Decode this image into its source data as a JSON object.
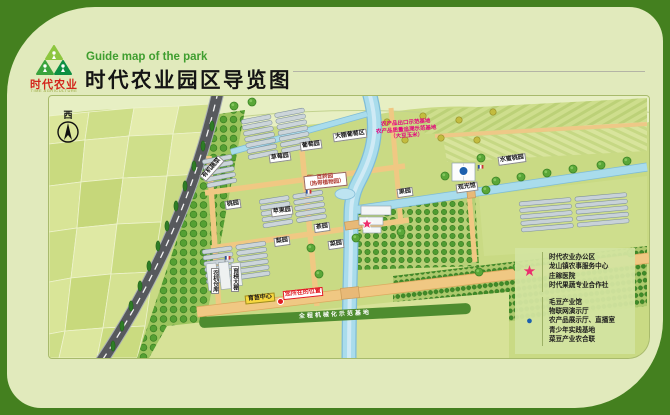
{
  "colors": {
    "page_background": "#44801f",
    "card_background": "#e1eabc",
    "brand_red": "#d3251c",
    "subtitle_green": "#3f9e2f",
    "star_marker": "#ea2f6e",
    "info_marker": "#1c60ae",
    "you_are_here_red": "#e11b22",
    "river_blue": "#a9dcec",
    "farm_road_tan": "#f0c883"
  },
  "header": {
    "logo_brand": "时代农业",
    "logo_caption": "TIME AGRICULTURE",
    "subtitle_en": "Guide map of the park",
    "title": "时代农业园区导览图"
  },
  "map": {
    "compass_label": "西",
    "notice": [
      "农产品出口示范基地",
      "农产品质量追溯示范基地",
      "（大豆玉米）"
    ],
    "band_label": "全程机械化示范基地",
    "seedling_center_label": "育苗中心",
    "you_are_here_label": "您所在的位置",
    "herb": {
      "line1": "百药园",
      "line2": "（热带植物园）"
    },
    "field_labels": [
      "大棚葡萄区",
      "葡萄园",
      "草莓园",
      "有机蔬菜",
      "果园",
      "水蜜桃园",
      "观光馆",
      "桃园",
      "苹果园",
      "茶园",
      "梨园",
      "菜园",
      "农机仓库",
      "育秧大棚"
    ],
    "legend": {
      "star_items": [
        "时代农业办公区",
        "龙山镇农事服务中心",
        "庄稼医院",
        "时代果蔬专业合作社"
      ],
      "circle_items": [
        "毛豆产业馆",
        "物联网演示厅",
        "农产品展示厅、直播室",
        "青少年实践基地",
        "菜豆产业农合联"
      ]
    }
  }
}
